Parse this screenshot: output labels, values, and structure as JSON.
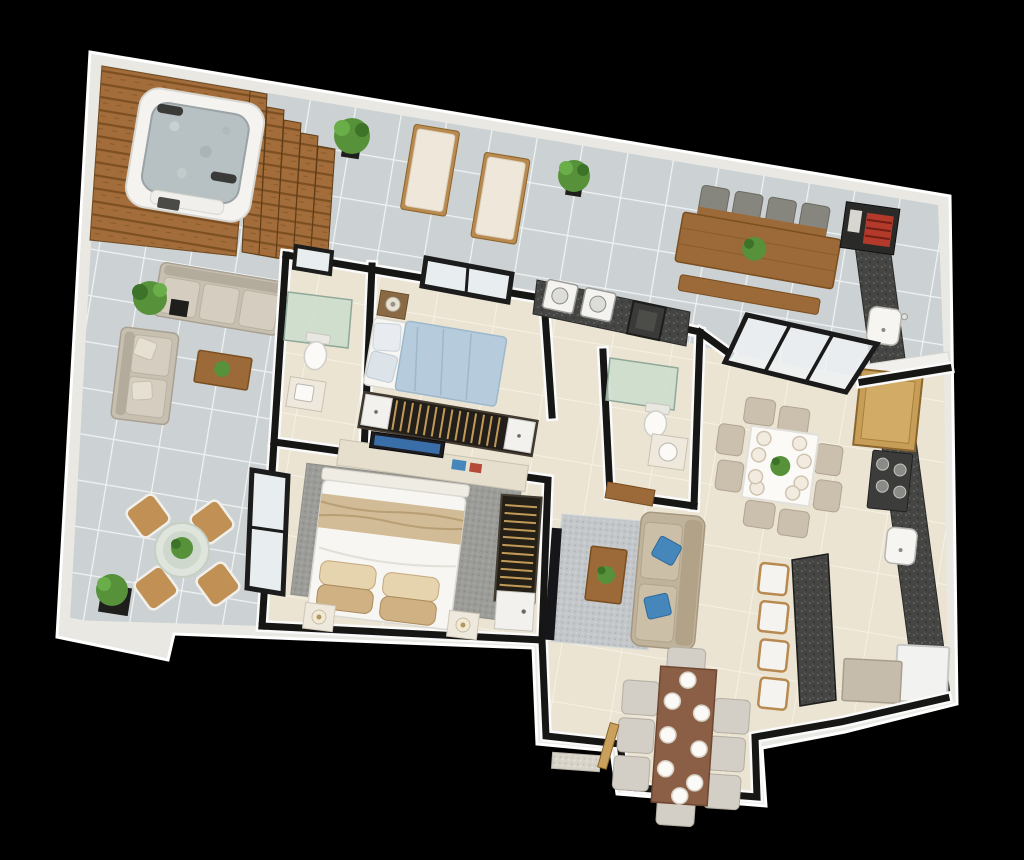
{
  "scene": {
    "kind": "3d-rendered-apartment-floor-plan",
    "view": "top-down perspective, plan tilted about 9 degrees clockwise",
    "background": "black"
  },
  "palette": {
    "bg": "#000000",
    "outer_wall": "#e9e8e2",
    "wall_dark": "#161614",
    "terrace_tile": "#ccd1d3",
    "terrace_grout": "#f0f3f4",
    "interior_tile": "#ebe4d3",
    "interior_grout": "#f6f1e4",
    "deck_wood": "#a26d3a",
    "deck_wood_dark": "#7c4f22",
    "furniture_wood": "#9c6a38",
    "granite": "#454543",
    "sofa_beige": "#c7c0b1",
    "sofa_taupe": "#c0b39c",
    "bed_white": "#f7f6f2",
    "bed_blue": "#b6ccdd",
    "throw_beige": "#d2bb97",
    "rug_living": "#c3c7c9",
    "rug_master": "#9c9c98",
    "pillow_blue": "#4587bb",
    "plant_green": "#57923b",
    "plant_green_dark": "#3c7328",
    "chair_beige": "#cbbfae",
    "chair_nook": "#d3cec6",
    "rattan": "#c09055",
    "glass_shower": "#c9dccd",
    "window_glass": "#e8eef0",
    "appliance_white": "#f4f3f0",
    "water": "#b7c0c2"
  },
  "rooms": [
    {
      "name": "terrace-deck",
      "items": [
        "hot-tub",
        "wood-deck-steps",
        "potted-plant"
      ]
    },
    {
      "name": "terrace-lounge",
      "items": [
        "sun-lounger",
        "sun-lounger",
        "potted-plant",
        "potted-plant"
      ]
    },
    {
      "name": "terrace-sitting",
      "items": [
        "outdoor-sofa-3seat",
        "outdoor-sofa-2seat",
        "coffee-table",
        "potted-plant"
      ]
    },
    {
      "name": "terrace-bistro",
      "items": [
        "round-glass-table",
        "rattan-chair",
        "rattan-chair",
        "rattan-chair",
        "rattan-chair",
        "potted-plant"
      ]
    },
    {
      "name": "gourmet-terrace",
      "items": [
        "wood-dining-table",
        "outdoor-chair-x4",
        "bench",
        "bbq-grill-station",
        "outdoor-counter-sink",
        "sliding-glass-door"
      ]
    },
    {
      "name": "laundry",
      "items": [
        "washing-machine",
        "washing-machine",
        "laundry-tank"
      ]
    },
    {
      "name": "bedroom-1",
      "items": [
        "double-bed-blue",
        "nightstand-lamp",
        "slatted-wardrobe",
        "window"
      ]
    },
    {
      "name": "bathroom-1",
      "items": [
        "glass-shower",
        "toilet",
        "vanity-sink",
        "window"
      ]
    },
    {
      "name": "bathroom-2",
      "items": [
        "glass-shower",
        "toilet",
        "vanity-sink"
      ]
    },
    {
      "name": "master-bedroom",
      "items": [
        "double-bed-white",
        "nightstand-lamp",
        "nightstand-lamp",
        "area-rug",
        "tv-console",
        "slatted-wardrobe",
        "window"
      ]
    },
    {
      "name": "living-room",
      "items": [
        "sofa-taupe",
        "blue-pillow",
        "blue-pillow",
        "area-rug",
        "coffee-table-plant",
        "tv-panel",
        "console-table"
      ]
    },
    {
      "name": "dining-room",
      "items": [
        "square-white-table",
        "dining-chair-x8",
        "place-setting-x8",
        "centerpiece-plant"
      ]
    },
    {
      "name": "kitchen",
      "items": [
        "granite-counter",
        "cooktop-4-burner",
        "sink",
        "sink",
        "wood-cabinet",
        "breakfast-island",
        "bar-stool-x4",
        "fridge",
        "dishwasher"
      ]
    },
    {
      "name": "dining-nook",
      "items": [
        "wood-long-table",
        "tufted-chair-x8",
        "plate-x8",
        "entry-door-threshold"
      ]
    }
  ]
}
